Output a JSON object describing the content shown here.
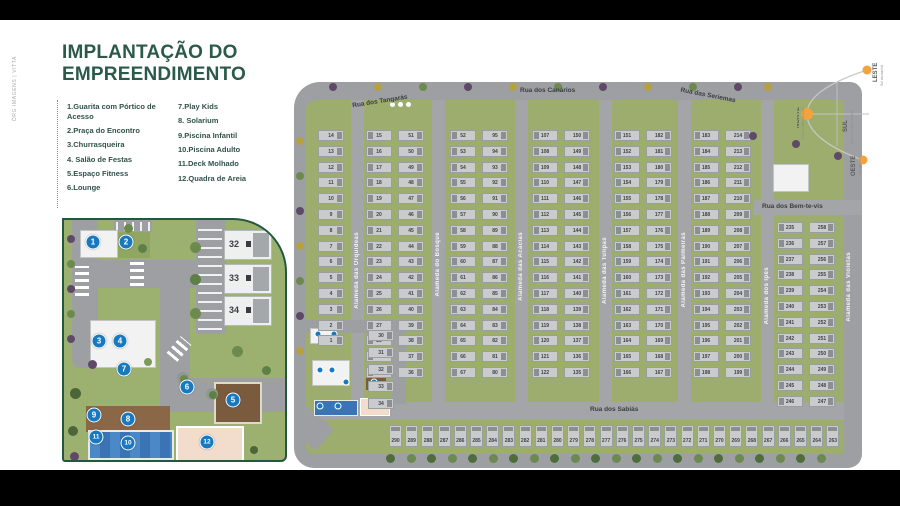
{
  "credit": "ÓRG IMAGENS | VITTA",
  "title": {
    "line1": "IMPLANTAÇÃO DO",
    "line2": "EMPREENDIMENTO"
  },
  "legend": {
    "col1": [
      "1.Guarita com Pórtico  de Acesso",
      "2.Praça do Encontro",
      "3.Churrasqueira",
      "4. Salão de Festas",
      "5.Espaço Fitness",
      "6.Lounge"
    ],
    "col2": [
      "7.Play Kids",
      "8. Solarium",
      "9.Piscina Infantil",
      "10.Piscina Adulto",
      "11.Deck Molhado",
      "12.Quadra de Areia"
    ]
  },
  "detail_map": {
    "houses": [
      {
        "label": "32",
        "y": 10
      },
      {
        "label": "33",
        "y": 44
      },
      {
        "label": "34",
        "y": 76
      }
    ],
    "markers": [
      {
        "n": "1",
        "x": 29,
        "y": 22
      },
      {
        "n": "2",
        "x": 62,
        "y": 22
      },
      {
        "n": "3",
        "x": 35,
        "y": 121
      },
      {
        "n": "4",
        "x": 56,
        "y": 121
      },
      {
        "n": "5",
        "x": 169,
        "y": 180
      },
      {
        "n": "6",
        "x": 123,
        "y": 167
      },
      {
        "n": "7",
        "x": 60,
        "y": 149
      },
      {
        "n": "8",
        "x": 64,
        "y": 199
      },
      {
        "n": "9",
        "x": 30,
        "y": 195
      },
      {
        "n": "10",
        "x": 64,
        "y": 223
      },
      {
        "n": "11",
        "x": 32,
        "y": 217
      },
      {
        "n": "12",
        "x": 143,
        "y": 222
      }
    ]
  },
  "site_map": {
    "ruas": [
      {
        "name": "Rua dos Tangarás",
        "x": 58,
        "y": 16,
        "rot": -9
      },
      {
        "name": "Rua dos Canários",
        "x": 226,
        "y": 5,
        "rot": 0
      },
      {
        "name": "Rua das Seriemas",
        "x": 386,
        "y": 10,
        "rot": 11
      },
      {
        "name": "Rua dos Bem-te-vis",
        "x": 468,
        "y": 121,
        "rot": 0
      },
      {
        "name": "Rua dos Sabiás",
        "x": 296,
        "y": 324,
        "rot": 0
      }
    ],
    "alamedas": [
      {
        "name": "Alameda das Orquídeas",
        "x": 57,
        "y": 150
      },
      {
        "name": "Alameda do Bosque",
        "x": 138,
        "y": 150
      },
      {
        "name": "Alameda das Acácias",
        "x": 221,
        "y": 150
      },
      {
        "name": "Alameda das Tulipas",
        "x": 305,
        "y": 155
      },
      {
        "name": "Alameda das Palmeiras",
        "x": 384,
        "y": 150
      },
      {
        "name": "Alameda dos Ipês",
        "x": 467,
        "y": 185
      },
      {
        "name": "Alameda das Violetas",
        "x": 549,
        "y": 170
      }
    ],
    "house_columns": [
      {
        "x": 24,
        "y": 48,
        "count": 14,
        "start": 14,
        "step": -1,
        "face": "r"
      },
      {
        "x": 72,
        "y": 48,
        "count": 16,
        "start": 15,
        "step": 1,
        "face": "l"
      },
      {
        "x": 104,
        "y": 48,
        "count": 16,
        "start": 51,
        "step": -1,
        "face": "r"
      },
      {
        "x": 156,
        "y": 48,
        "count": 16,
        "start": 52,
        "step": 1,
        "face": "l"
      },
      {
        "x": 188,
        "y": 48,
        "count": 16,
        "start": 95,
        "step": -1,
        "face": "r"
      },
      {
        "x": 238,
        "y": 48,
        "count": 16,
        "start": 107,
        "step": 1,
        "face": "l"
      },
      {
        "x": 270,
        "y": 48,
        "count": 16,
        "start": 150,
        "step": -1,
        "face": "r"
      },
      {
        "x": 320,
        "y": 48,
        "count": 16,
        "start": 151,
        "step": 1,
        "face": "l"
      },
      {
        "x": 352,
        "y": 48,
        "count": 16,
        "start": 182,
        "step": -1,
        "face": "r"
      },
      {
        "x": 399,
        "y": 48,
        "count": 16,
        "start": 183,
        "step": 1,
        "face": "l"
      },
      {
        "x": 431,
        "y": 48,
        "count": 16,
        "start": 214,
        "step": -1,
        "face": "r"
      },
      {
        "x": 483,
        "y": 140,
        "count": 12,
        "start": 235,
        "step": 1,
        "face": "l"
      },
      {
        "x": 515,
        "y": 140,
        "count": 12,
        "start": 258,
        "step": -1,
        "face": "r"
      },
      {
        "x": 74,
        "y": 248,
        "count": 5,
        "start": 30,
        "step": 1,
        "face": "r",
        "spacing": 17
      }
    ],
    "bottom_row": {
      "x": 95,
      "y": 343,
      "count": 28,
      "start": 290,
      "step": -1,
      "spacing": 16.2
    }
  },
  "compass": {
    "leste": {
      "label": "LESTE",
      "sub": "Sol da manhã"
    },
    "norte": {
      "label": "NORTE",
      "sub": "Maior incidência solar"
    },
    "sul": {
      "label": "SUL",
      "sub": "Menor incidência solar"
    },
    "oeste": {
      "label": "OESTE",
      "sub": "Sol da tarde"
    }
  },
  "colors": {
    "accent_green": "#2c5a4a",
    "marker_blue": "#1779c0",
    "pool_blue": "#3a74b5",
    "sun_orange": "#f2a33c"
  }
}
